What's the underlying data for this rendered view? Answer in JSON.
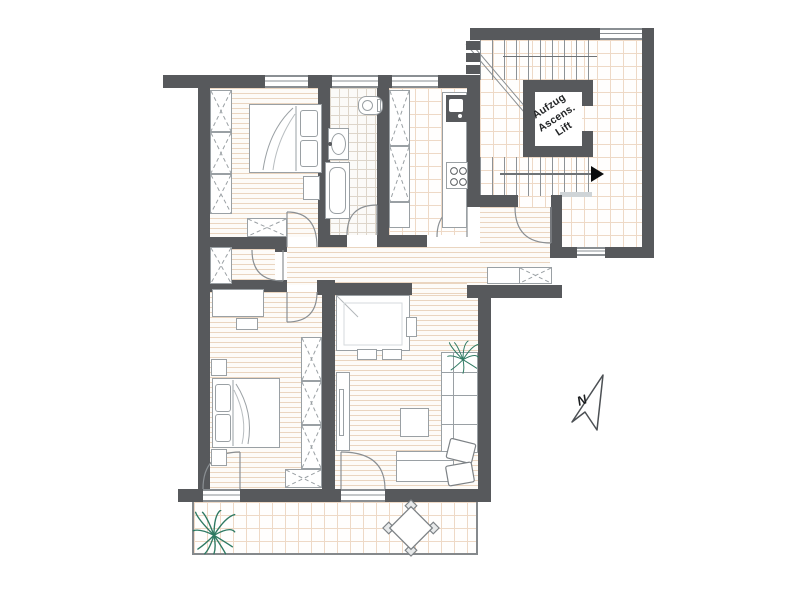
{
  "floorplan": {
    "elevator_label": {
      "line1": "Aufzug",
      "line2": "Ascens.",
      "line3": "Lift"
    },
    "compass": {
      "north_label": "N"
    }
  },
  "colors": {
    "wall": "#57595c",
    "furnLine": "#9aa0a4",
    "woodLine": "#ead5c0",
    "tileLine": "#eed9c6",
    "bathTile": "#ddd5ca",
    "doorLine": "#8a8f93",
    "plant": "#2f7a63",
    "arrowDark": "#0b0c0d",
    "text": "#232527"
  }
}
